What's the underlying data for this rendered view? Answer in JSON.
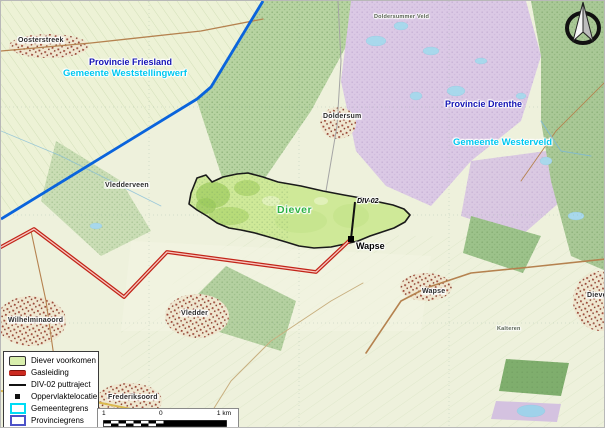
{
  "region_labels": [
    {
      "text": "Provincie Friesland"
    },
    {
      "text": "Gemeente Weststellingwerf"
    },
    {
      "text": "Provincie Drenthe"
    },
    {
      "text": "Gemeente Westerveld"
    }
  ],
  "annotations": {
    "deposit": "Diever",
    "well": "DIV-02",
    "surface_location": "Wapse"
  },
  "places": [
    {
      "text": "Oosterstreek"
    },
    {
      "text": "Doldersummer Veld"
    },
    {
      "text": "Doldersum"
    },
    {
      "text": "Vledderveen"
    },
    {
      "text": "Vledder"
    },
    {
      "text": "Wilhelminaoord"
    },
    {
      "text": "Frederiksoord"
    },
    {
      "text": "Wapse"
    },
    {
      "text": "Kalteren"
    },
    {
      "text": "Diever"
    }
  ],
  "legend": {
    "items": [
      {
        "label": "Diever voorkomen",
        "swatch": "area"
      },
      {
        "label": "Gasleiding",
        "swatch": "line-red"
      },
      {
        "label": "DIV-02 puttraject",
        "swatch": "line-black"
      },
      {
        "label": "Oppervlaktelocatie",
        "swatch": "point"
      },
      {
        "label": "Gemeentegrens",
        "swatch": "rect-cyan"
      },
      {
        "label": "Provinciegrens",
        "swatch": "rect-blue"
      }
    ]
  },
  "scalebar": {
    "left": "1",
    "zero": "0",
    "right": "1 km"
  },
  "colors": {
    "deposit_fill": "#cfe998",
    "deposit_border": "#1a1a1a",
    "gas_pipeline": "#c22418",
    "well_trajectory": "#111111",
    "municipal_border": "#00dcf5",
    "provincial_border": "#0a64dc",
    "provincie_label": "#1414b4",
    "gemeente_label": "#00c8f0",
    "deposit_label": "#2eb344"
  }
}
